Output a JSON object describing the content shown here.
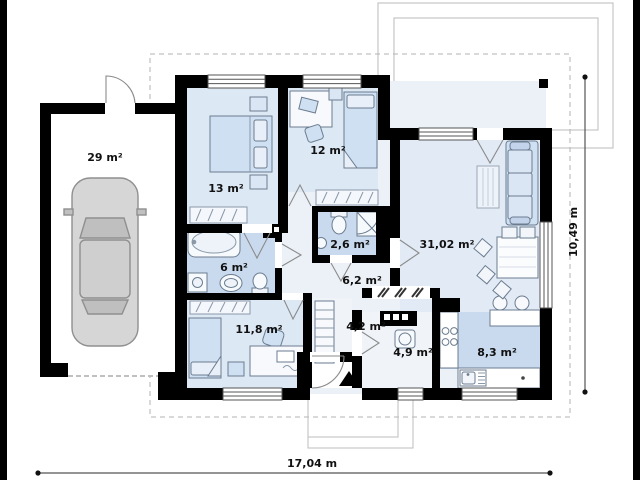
{
  "plan": {
    "title": "single-storey house floor plan",
    "rooms": [
      {
        "id": "garage",
        "label": "29 m²"
      },
      {
        "id": "bedroom-1",
        "label": "13 m²"
      },
      {
        "id": "bedroom-2",
        "label": "12 m²"
      },
      {
        "id": "wc",
        "label": "2,6 m²"
      },
      {
        "id": "living-room",
        "label": "31,02 m²"
      },
      {
        "id": "bathroom",
        "label": "6 m²"
      },
      {
        "id": "hallway",
        "label": "6,2 m²"
      },
      {
        "id": "bedroom-3",
        "label": "11,8 m²"
      },
      {
        "id": "entry-hall",
        "label": "4,2 m²"
      },
      {
        "id": "utility",
        "label": "4,9 m²"
      },
      {
        "id": "kitchen",
        "label": "8,3 m²"
      }
    ],
    "dimensions": {
      "width_label": "17,04 m",
      "height_label": "10,49 m"
    },
    "colors": {
      "wall": "#000000",
      "room_floor": "#dde8f5",
      "wet_room_floor": "#c9daee",
      "corridor_floor": "#ecf1f8",
      "furniture": "#cfe0f3",
      "outline_gray": "#bdbdbd"
    }
  }
}
